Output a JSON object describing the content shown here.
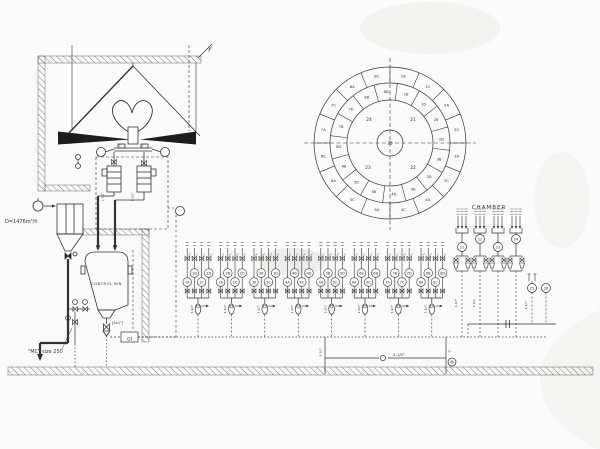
{
  "labels": {
    "wall_axis": "y",
    "flow_rate": "D=1476m³/h",
    "control_bin": "CONTROL BIN",
    "mc_size": "\"MC\" size 250",
    "four_by": "[4x1\"]",
    "gi_tag": "GI",
    "chamber_title": "CHAMBER",
    "pipe_2_5": "2-1/2\"",
    "pipe_1_5": "1-1/2\"",
    "pipe_1": "1\"",
    "pipe_2": "2\""
  },
  "chamber_data": {
    "type": "radial-diagram",
    "center": "25",
    "quadrants": {
      "top_left": "24",
      "top_right": "21",
      "bottom_right": "22",
      "bottom_left": "23"
    },
    "outer_ring": [
      "1A",
      "1C",
      "2A",
      "2C",
      "3A",
      "3C",
      "4A",
      "4C",
      "5A",
      "5C",
      "6A",
      "6C",
      "7A",
      "7C",
      "8A",
      "8C"
    ],
    "middle_ring": [
      "1B",
      "1D",
      "2B",
      "2D",
      "3B",
      "3D",
      "4B",
      "4D",
      "5B",
      "5D",
      "6B",
      "6D",
      "7B",
      "7D",
      "8B",
      "8D"
    ]
  },
  "manifold": {
    "injector_size": "1-1/2\"",
    "groups": [
      {
        "labels": [
          "1A",
          "1B",
          "1C",
          "1D"
        ]
      },
      {
        "labels": [
          "2A",
          "2B",
          "2C",
          "2D"
        ]
      },
      {
        "labels": [
          "3A",
          "3B",
          "3C",
          "3D"
        ]
      },
      {
        "labels": [
          "4A",
          "4B",
          "4C",
          "4D"
        ]
      },
      {
        "labels": [
          "5A",
          "5B",
          "5C",
          "5D"
        ]
      },
      {
        "labels": [
          "6A",
          "6B",
          "6C",
          "6D"
        ]
      },
      {
        "labels": [
          "7A",
          "7B",
          "7C",
          "7D"
        ]
      },
      {
        "labels": [
          "8A",
          "8B",
          "8C",
          "8D"
        ]
      }
    ]
  },
  "stations": {
    "circles": [
      "21",
      "22",
      "23",
      "24"
    ],
    "aux": [
      "25",
      "26"
    ]
  }
}
